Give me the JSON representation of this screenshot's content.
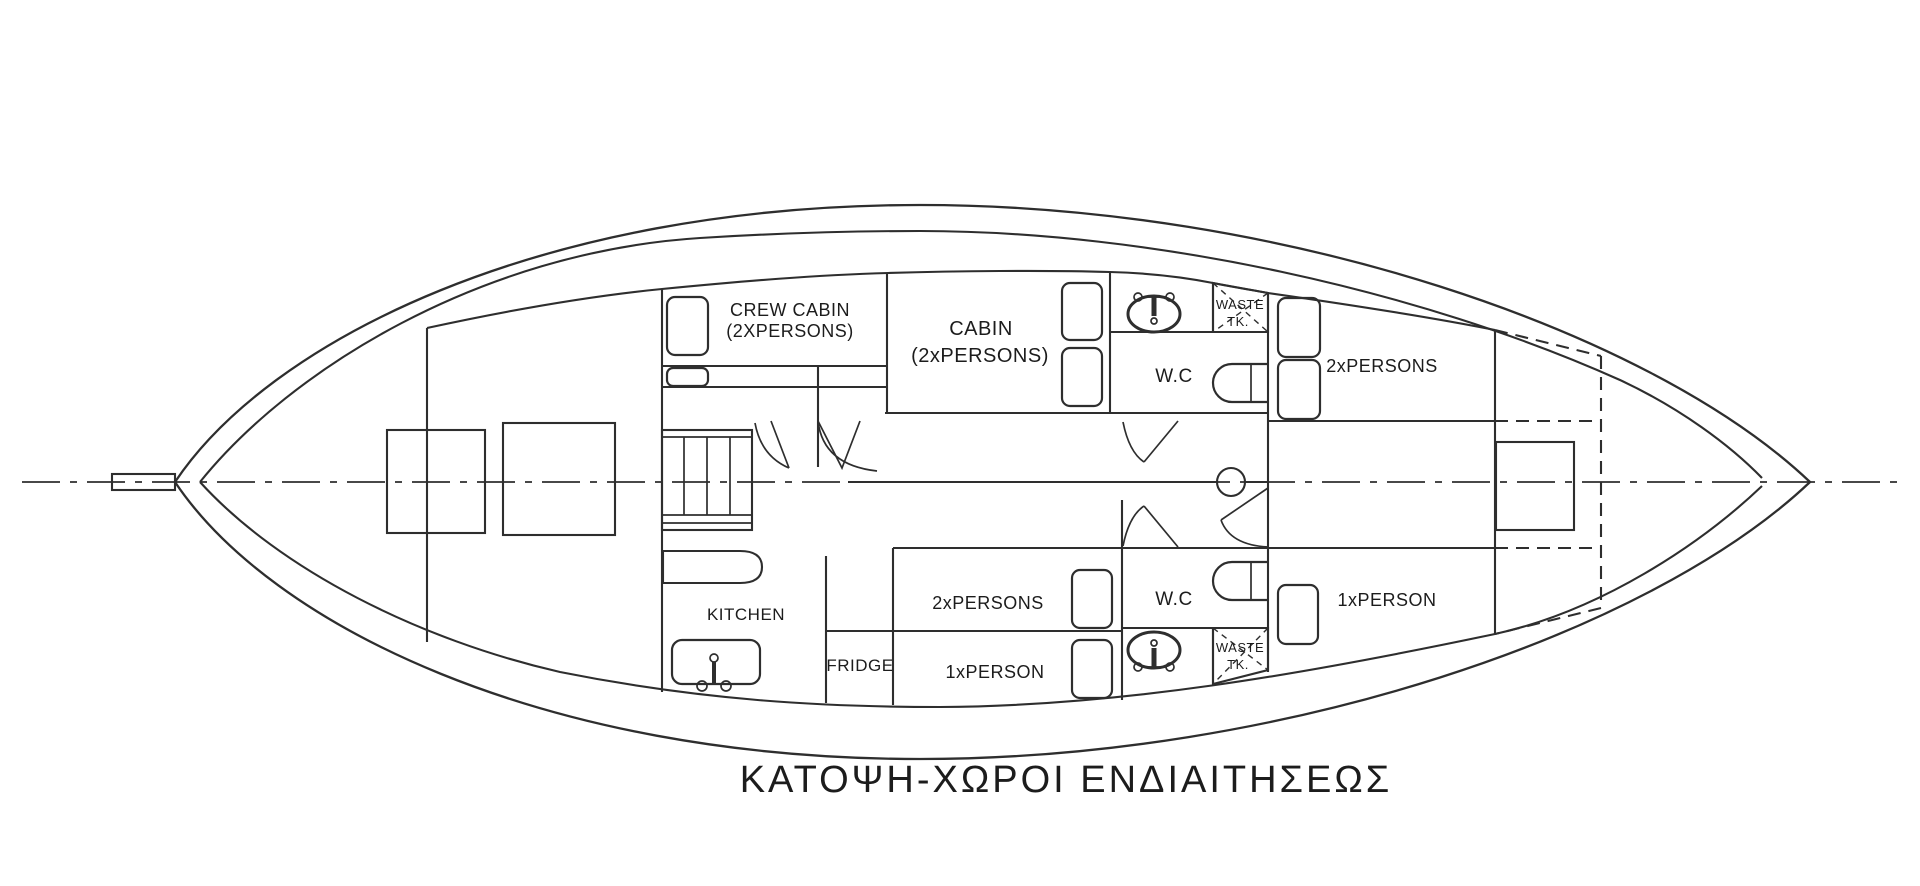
{
  "drawing": {
    "title": "ΚΑΤΟΨΗ-ΧΩΡΟΙ ΕΝΔΙΑΙΤΗΣΕΩΣ",
    "labels": {
      "crew_cabin_line1": "CREW CABIN",
      "crew_cabin_line2": "(2XPERSONS)",
      "cabin_line1": "CABIN",
      "cabin_line2": "(2xPERSONS)",
      "wc_upper": "W.C",
      "wc_lower": "W.C",
      "waste_tank_upper_line1": "WASTE",
      "waste_tank_upper_line2": "TK.",
      "waste_tank_lower_line1": "WASTE",
      "waste_tank_lower_line2": "TK.",
      "cabin_2p_forward": "2xPERSONS",
      "cabin_2p_aft_lower": "2xPERSONS",
      "cabin_1p_mid_lower": "1xPERSON",
      "cabin_1p_forward_lower": "1xPERSON",
      "kitchen": "KITCHEN",
      "fridge": "FRIDGE"
    },
    "colors": {
      "line": "#2e2e2e",
      "text": "#1c1c1c",
      "background": "#ffffff"
    }
  }
}
